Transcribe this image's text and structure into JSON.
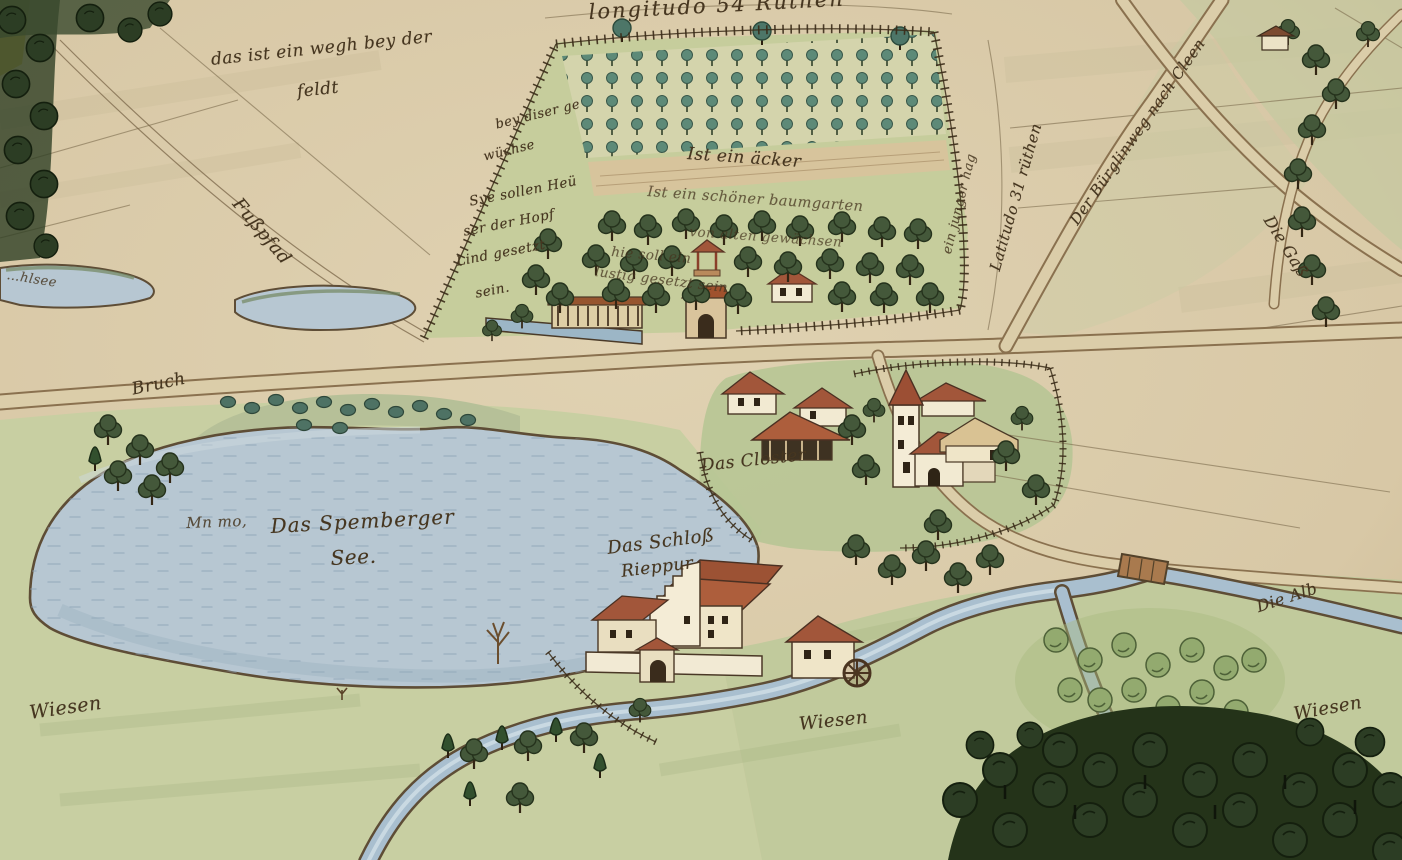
{
  "map": {
    "palette": {
      "parchment": "#d8c8a6",
      "field_light": "#e0d2b2",
      "meadow": "#c8cfa2",
      "garden_green": "#c6cd9c",
      "lake_blue": "#b7c7d2",
      "stream_blue": "#a9bfcf",
      "forest_dark": "#2c3d24",
      "tree_green": "#44583a",
      "nursery_teal": "#5d8a78",
      "roof_red": "#a2563a",
      "roof_tan": "#d9c293",
      "wall_white": "#f2ead2",
      "ink": "#46361f",
      "fence": "#3a2b18",
      "road_edge": "#8a714f"
    },
    "labels": {
      "longitudo": {
        "text": "longitudo 54 Rüthen"
      },
      "weg_note_line1": {
        "text": "das ist ein wegh bey der"
      },
      "weg_note_line2": {
        "text": "feldt"
      },
      "fusspfad": {
        "text": "Fußpfad"
      },
      "pond_label": {
        "text": "…hlsee"
      },
      "garden_note_line1": {
        "text": "bey diser ge"
      },
      "garden_note_line2": {
        "text": "wüchse"
      },
      "garden_note_line3": {
        "text": "Sye sollen Heü"
      },
      "garden_note_line4": {
        "text": "ser der Hopf"
      },
      "garden_note_line5": {
        "text": "Lind gesetzt"
      },
      "garden_note_line6": {
        "text": "sein."
      },
      "acker_note": {
        "text": "Ist ein äcker"
      },
      "orchard_note_line1": {
        "text": "Ist ein schöner baumgarten"
      },
      "orchard_note_line2": {
        "text": "von alten gewächsen"
      },
      "orchard_note_line3": {
        "text": "hie soll ein"
      },
      "orchard_note_line4": {
        "text": "lustig gesetzt sein"
      },
      "latitudo": {
        "text": "Latitudo 31 rüthen"
      },
      "road_note": {
        "text": "Der Bürglinweg nach Cleen"
      },
      "gasse_note": {
        "text": "Die Gaß"
      },
      "bruch_note": {
        "text": "Bruch"
      },
      "lake_name_line1": {
        "text": "Das Spemberger"
      },
      "lake_name_line2": {
        "text": "See."
      },
      "lake_doodle": {
        "text": "Mn mo,"
      },
      "closter_note": {
        "text": "Das Closter"
      },
      "schloss_line1": {
        "text": "Das Schloß"
      },
      "schloss_line2": {
        "text": "Rieppur"
      },
      "wiesen_left": {
        "text": "Wiesen"
      },
      "wiesen_mid": {
        "text": "Wiesen"
      },
      "wiesen_right": {
        "text": "Wiesen"
      },
      "alb_note": {
        "text": "Die Alb"
      },
      "hag_note": {
        "text": "ein junger hag"
      }
    }
  }
}
